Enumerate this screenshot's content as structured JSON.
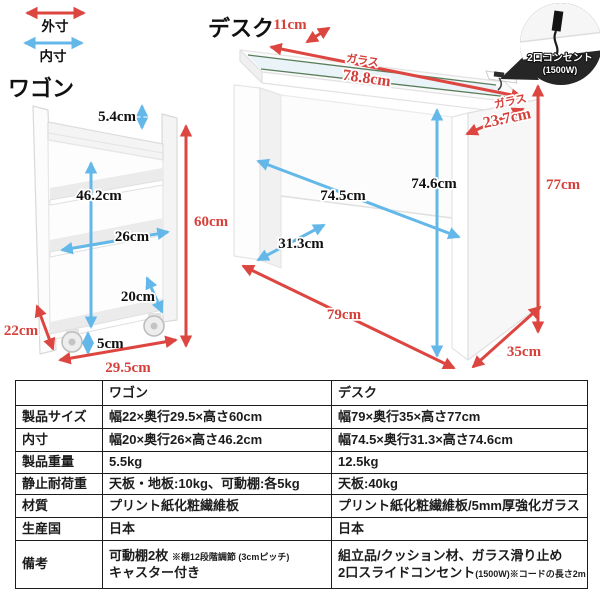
{
  "legend": {
    "outer_label": "外寸",
    "inner_label": "内寸"
  },
  "wagon": {
    "title": "ワゴン",
    "dims": {
      "top_panel": "5.4cm",
      "inner_height": "46.2cm",
      "inner_depth": "26cm",
      "inner_width": "20cm",
      "outer_height": "60cm",
      "outer_width": "22cm",
      "caster_height": "5cm",
      "outer_depth": "29.5cm"
    }
  },
  "desk": {
    "title": "デスク",
    "glass_label": "ガラス",
    "dims": {
      "top_strip_depth": "11cm",
      "glass_width": "78.8cm",
      "glass_depth": "23.7cm",
      "inner_height": "74.6cm",
      "inner_width": "74.5cm",
      "inner_depth": "31.3cm",
      "outer_height": "77cm",
      "outer_width": "79cm",
      "outer_depth": "35cm"
    },
    "callout": {
      "line1": "2口コンセント",
      "line2": "(1500W)"
    }
  },
  "table": {
    "col_headers": {
      "wagon": "ワゴン",
      "desk": "デスク"
    },
    "rows": [
      {
        "label": "製品サイズ",
        "wagon": "幅22×奥行29.5×高さ60cm",
        "desk": "幅79×奥行35×高さ77cm"
      },
      {
        "label": "内寸",
        "wagon": "幅20×奥行26×高さ46.2cm",
        "desk": "幅74.5×奥行31.3×高さ74.6cm"
      },
      {
        "label": "製品重量",
        "wagon": "5.5kg",
        "desk": "12.5kg"
      },
      {
        "label": "静止耐荷重",
        "wagon": "天板・地板:10kg、可動棚:各5kg",
        "desk": "天板:40kg"
      },
      {
        "label": "材質",
        "wagon": "プリント紙化粧繊維板",
        "desk": "プリント紙化粧繊維板/5mm厚強化ガラス"
      },
      {
        "label": "生産国",
        "wagon": "日本",
        "desk": "日本"
      }
    ],
    "remarks": {
      "label": "備考",
      "wagon_line1_main": "可動棚2枚",
      "wagon_line1_note": "※棚12段階調節 (3cmピッチ)",
      "wagon_line2": "キャスター付き",
      "desk_line1": "組立品/クッション材、ガラス滑り止め",
      "desk_line2_main": "2口スライドコンセント",
      "desk_line2_note": "(1500W)※コードの長さ2m"
    }
  },
  "colors": {
    "outer_dim_red": "#dd4640",
    "inner_dim_blue": "#63b8e9",
    "glass_edge_green": "#5a7d5c"
  }
}
